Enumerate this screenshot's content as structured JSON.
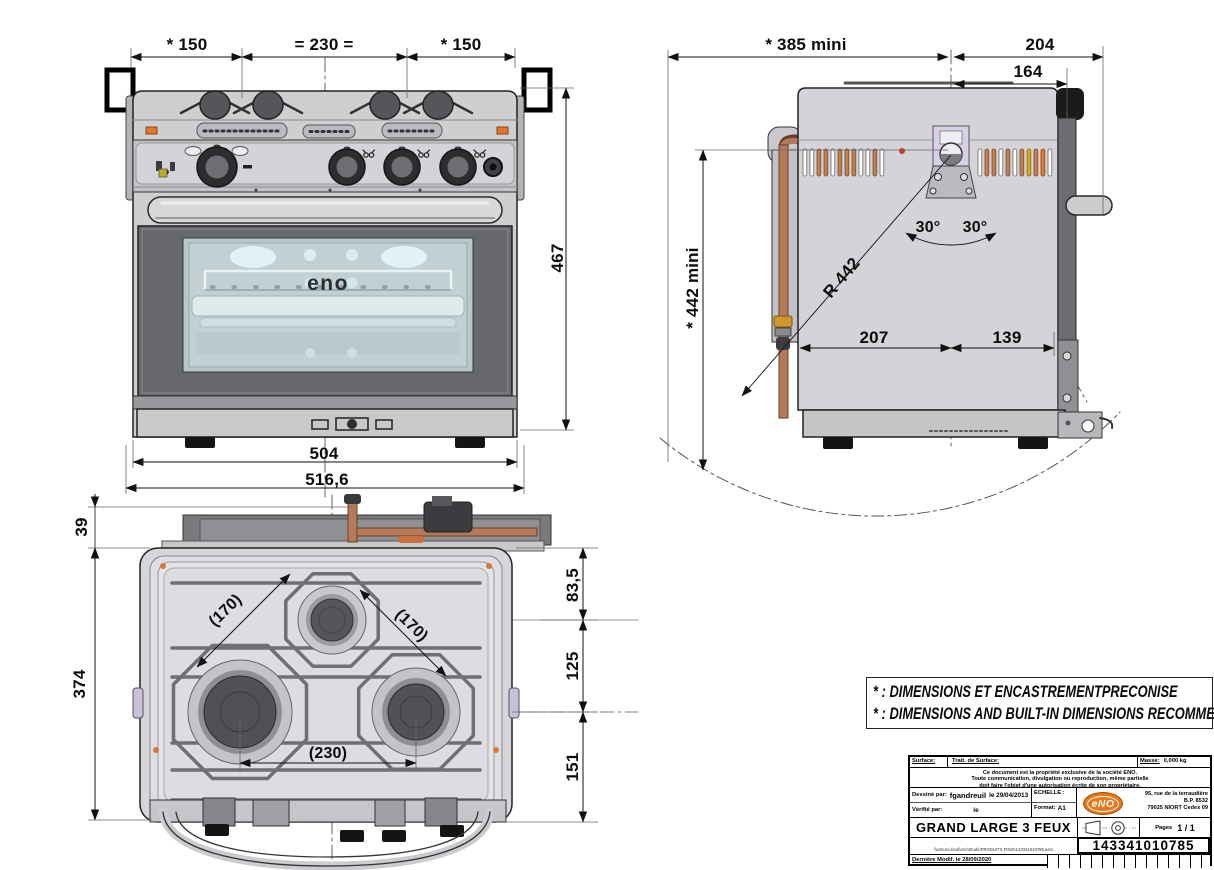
{
  "drawing": {
    "front_view": {
      "dim_150_left": "* 150",
      "dim_230": "= 230 =",
      "dim_150_right": "* 150",
      "dim_467": "467",
      "dim_504": "504",
      "dim_516": "516,6",
      "logo": "eno"
    },
    "side_view": {
      "dim_385": "* 385  mini",
      "dim_204": "204",
      "dim_164": "164",
      "dim_442": "* 442 mini",
      "angle_left": "30°",
      "angle_right": "30°",
      "radius": "R 442",
      "dim_207": "207",
      "dim_139": "139"
    },
    "top_view": {
      "dim_39": "39",
      "dim_374": "374",
      "dim_83": "83,5",
      "dim_125": "125",
      "dim_151": "151",
      "dim_170_left": "(170)",
      "dim_170_right": "(170)",
      "dim_230": "(230)"
    }
  },
  "notes": {
    "line_fr": "* : DIMENSIONS ET ENCASTREMENTPRECONISE",
    "line_en": "* : DIMENSIONS AND BUILT-IN DIMENSIONS RECOMMENDED"
  },
  "title_block": {
    "surface_label": "Surface:",
    "treatment_label": "Trait. de Surface:",
    "mass_label": "Masse:",
    "mass_value": "0,000 kg",
    "notice_1": "Ce document est la propriété exclusive de la société ENO.",
    "notice_2": "Toute communication, divulgation ou reproduction, même partielle",
    "notice_3": "doit faire l'objet d'une autorisation écrite de son propriétaire.",
    "drawn_label": "Dessiné par:",
    "drawn_name": "fgandreuil",
    "drawn_date": "le 29/04/2013",
    "checked_label": "Vérifié par:",
    "checked_date": "le",
    "scale_label": "ECHELLE :",
    "format_label": "Format:",
    "format_value": "A1",
    "logo_text": "eNO",
    "address_1": "95, rue de la terraudière",
    "address_2": "B.P. 8532",
    "address_3": "79025 NIORT Cedex 09",
    "title": "GRAND LARGE 3 FEUX",
    "pages_label": "Pages",
    "pages_value": "1 / 1",
    "file_path": "\\\\enteno.local\\enc\\Etude\\PRODUITS FINIS\\143341010785.asm",
    "part_number": "143341010785",
    "modified_label": "Dernière Modif. le  28/09/2020"
  },
  "colors": {
    "accent_orange": "#e87818",
    "copper_pipe": "#b5795a",
    "gimbal_lavender": "#d9cfe8",
    "glass_blue": "#c3d0d3"
  }
}
